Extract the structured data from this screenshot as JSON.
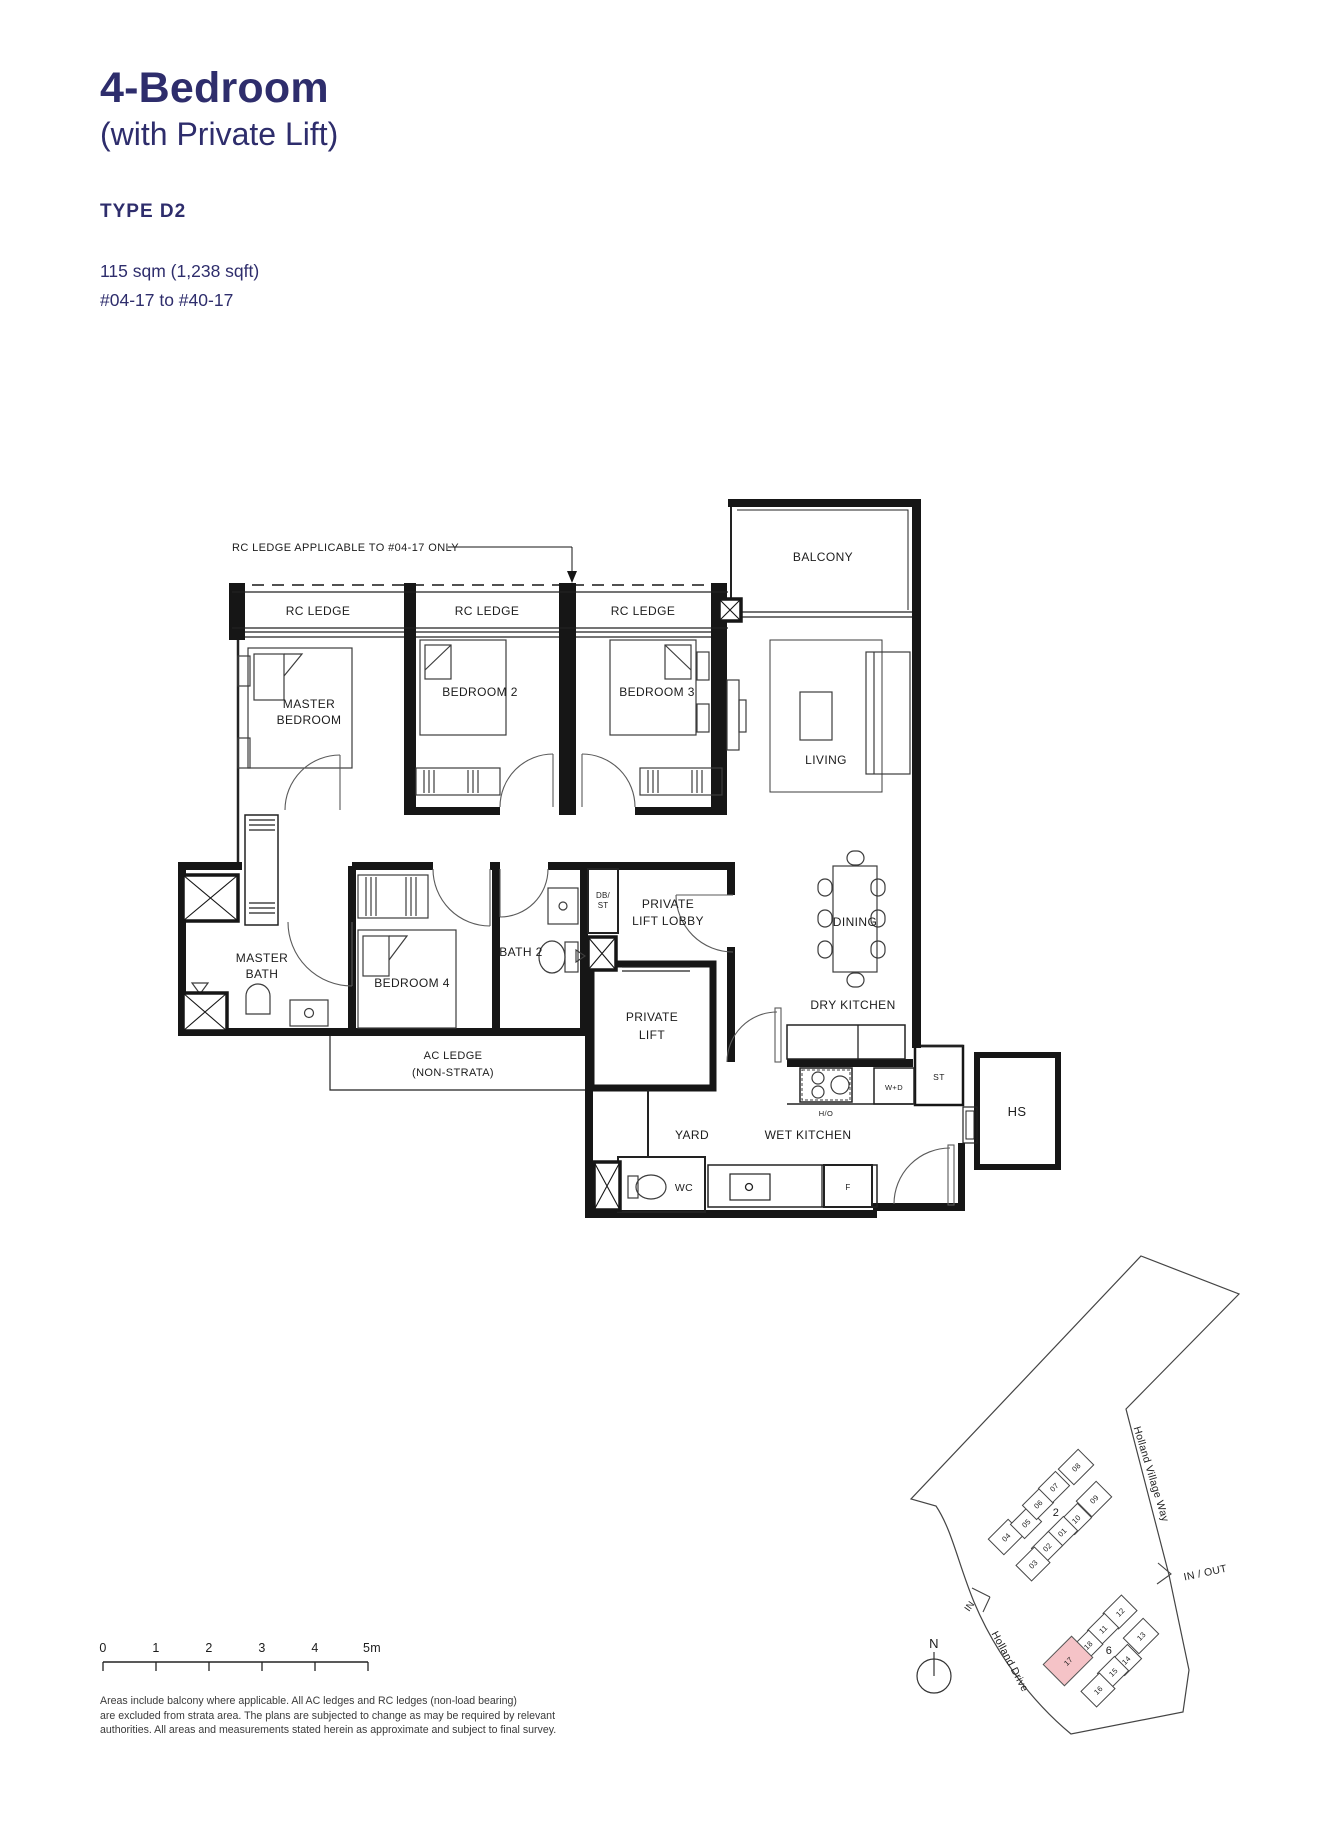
{
  "header": {
    "title": "4-Bedroom",
    "subtitle": "(with Private Lift)",
    "type": "TYPE D2",
    "area": "115 sqm (1,238 sqft)",
    "stack": "#04-17 to #40-17"
  },
  "floorplan": {
    "callout": "RC LEDGE APPLICABLE TO #04-17 ONLY",
    "labels": {
      "rc_ledge": "RC LEDGE",
      "balcony": "BALCONY",
      "master_bedroom": [
        "MASTER",
        "BEDROOM"
      ],
      "bedroom2": "BEDROOM 2",
      "bedroom3": "BEDROOM 3",
      "living": "LIVING",
      "dining": "DINING",
      "dry_kitchen": "DRY KITCHEN",
      "wet_kitchen": "WET KITCHEN",
      "yard": "YARD",
      "master_bath": [
        "MASTER",
        "BATH"
      ],
      "bedroom4": "BEDROOM 4",
      "bath2": "BATH 2",
      "db_st": [
        "DB/",
        "ST"
      ],
      "private_lift_lobby": [
        "PRIVATE",
        "LIFT LOBBY"
      ],
      "private_lift": [
        "PRIVATE",
        "LIFT"
      ],
      "ac_ledge": [
        "AC LEDGE",
        "(NON-STRATA)"
      ],
      "hs": "HS",
      "st": "ST",
      "wd": "W+D",
      "ho": "H/O",
      "fridge": "F",
      "wc": "WC"
    }
  },
  "scalebar": {
    "ticks": [
      "0",
      "1",
      "2",
      "3",
      "4",
      "5m"
    ]
  },
  "siteplan": {
    "roads": {
      "holland_village_way": "Holland Village Way",
      "holland_drive": "Holland Drive"
    },
    "in_out": "IN / OUT",
    "in_label": "IN",
    "north": "N",
    "block2": {
      "label": "2",
      "units": [
        "04",
        "05",
        "06",
        "07",
        "08",
        "09",
        "10",
        "01",
        "02",
        "03"
      ]
    },
    "block6": {
      "label": "6",
      "units": [
        "12",
        "11",
        "13",
        "18",
        "14",
        "15",
        "16"
      ],
      "highlighted_unit": "17"
    },
    "highlight_color": "#f5c3c7"
  },
  "footer": {
    "lines": [
      "Areas include balcony where applicable. All AC ledges and RC ledges (non-load bearing)",
      "are excluded from strata area. The plans are subjected to change as may be required by relevant",
      "authorities. All areas and measurements stated herein as approximate and subject to final survey."
    ]
  }
}
